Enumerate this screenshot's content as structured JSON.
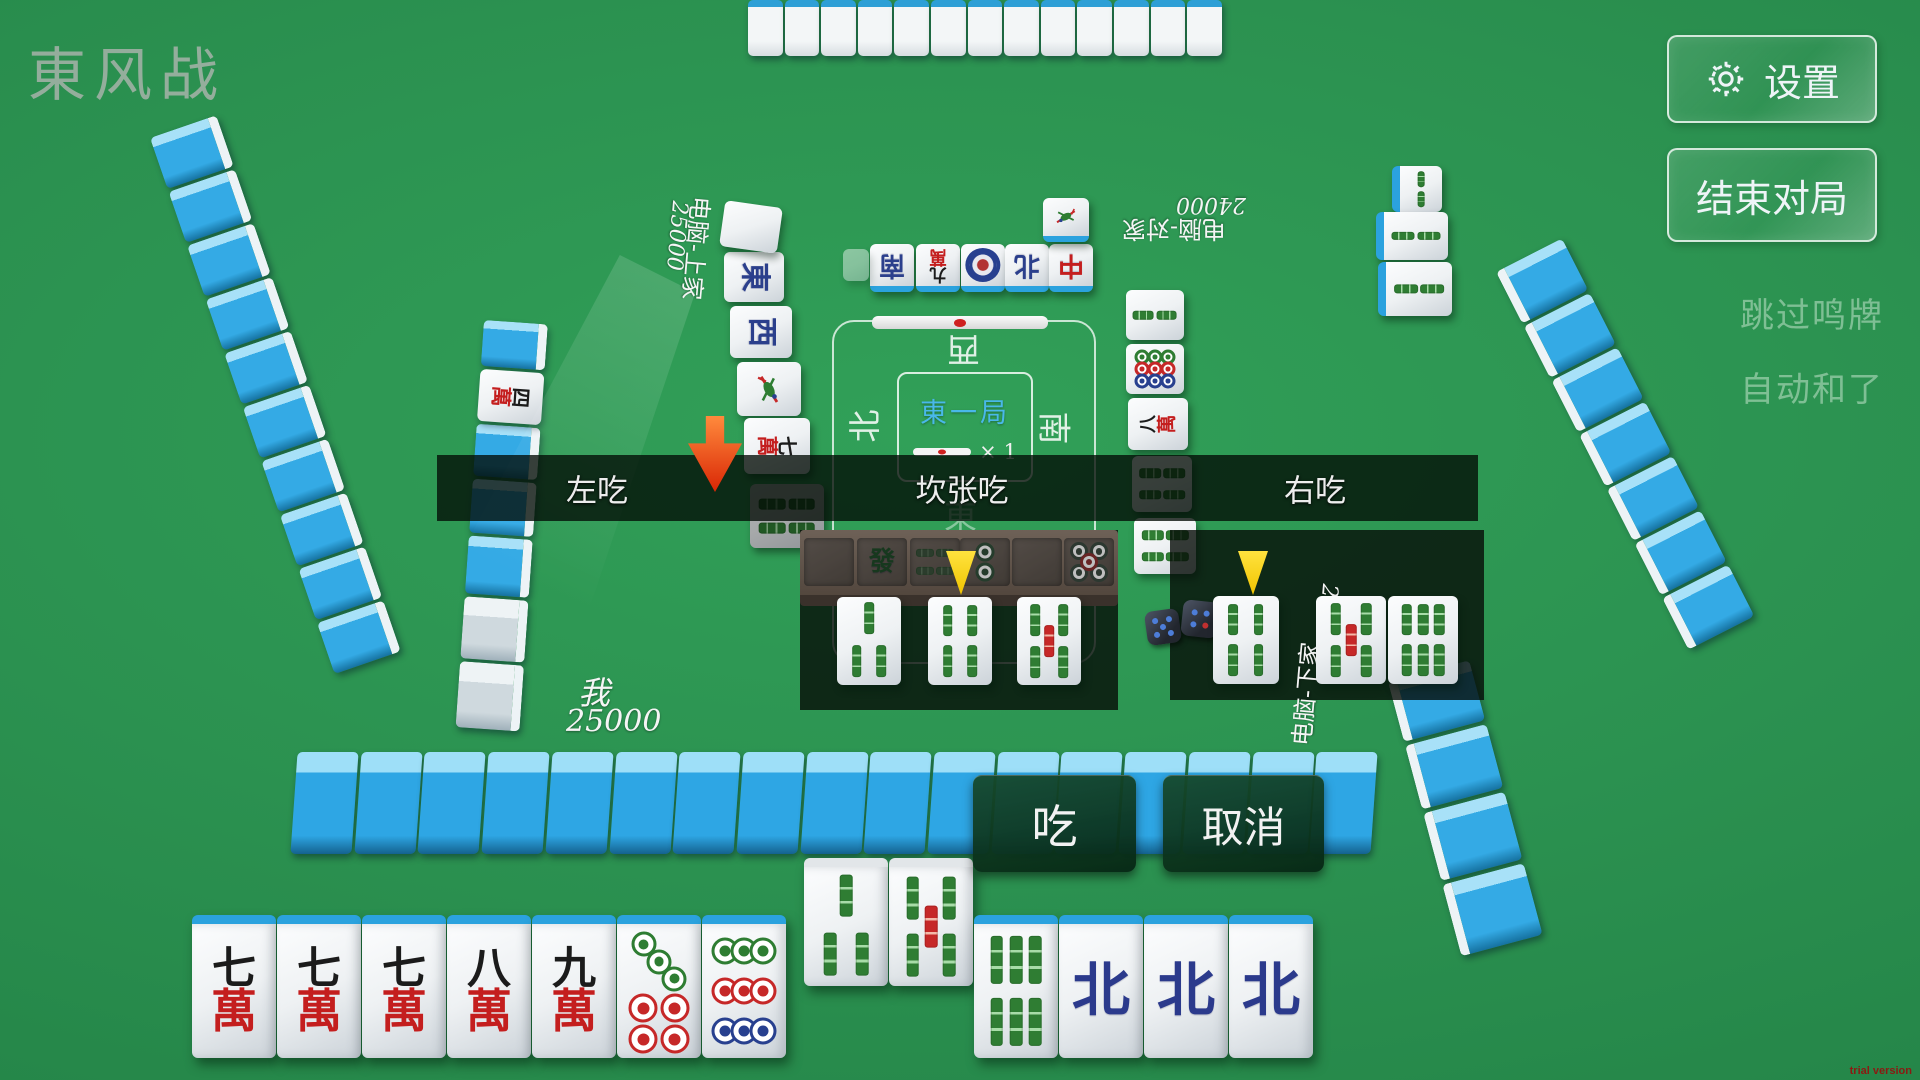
{
  "title": "東风战",
  "top_right": {
    "settings": "设置",
    "end_game": "结束对局"
  },
  "right_options": {
    "skip_call": "跳过鸣牌",
    "auto_win": "自动和了"
  },
  "call_bar": {
    "left": "左吃",
    "middle": "坎张吃",
    "right": "右吃"
  },
  "action_buttons": {
    "chi": "吃",
    "cancel": "取消"
  },
  "center": {
    "round": "東一局",
    "multiplier": "× 1",
    "wind_top": "西",
    "wind_left": "北",
    "wind_right": "南",
    "wind_bottom": "東"
  },
  "players": {
    "left": {
      "name": "电脑-上家",
      "score": "25000"
    },
    "top": {
      "name": "电脑-对家",
      "score": "24000"
    },
    "right": {
      "name": "电脑-下家",
      "score": "25000"
    },
    "self": {
      "name": "我",
      "score": "25000"
    }
  },
  "man_char": "萬",
  "dora_indicator": {
    "suit": "man",
    "num": "四"
  },
  "hand": {
    "tiles": [
      {
        "suit": "man",
        "num": "七"
      },
      {
        "suit": "man",
        "num": "七"
      },
      {
        "suit": "man",
        "num": "七"
      },
      {
        "suit": "man",
        "num": "八"
      },
      {
        "suit": "man",
        "num": "九"
      },
      {
        "suit": "pin",
        "value": 7
      },
      {
        "suit": "pin",
        "value": 9
      },
      {
        "suit": "sou",
        "value": 3,
        "raised": true
      },
      {
        "suit": "sou",
        "value": 5,
        "raised": true
      },
      {
        "suit": "sou",
        "value": 6
      },
      {
        "suit": "honor",
        "label": "北"
      },
      {
        "suit": "honor",
        "label": "北"
      },
      {
        "suit": "honor",
        "label": "北"
      }
    ]
  },
  "chi_preview": {
    "middle": [
      {
        "suit": "sou",
        "value": 3
      },
      {
        "suit": "sou",
        "value": 4
      },
      {
        "suit": "sou",
        "value": 5
      }
    ],
    "right_called": {
      "suit": "sou",
      "value": 4
    },
    "right_pair": [
      {
        "suit": "sou",
        "value": 5
      },
      {
        "suit": "sou",
        "value": 6
      }
    ]
  },
  "discards": {
    "left": [
      {
        "type": "text",
        "label": "東",
        "color": "#2b3f8c"
      },
      {
        "type": "text",
        "label": "西",
        "color": "#2b3f8c"
      },
      {
        "type": "bird"
      },
      {
        "type": "man",
        "num": "七"
      },
      {
        "type": "souflat",
        "chains": 4
      }
    ],
    "top": [
      {
        "type": "text",
        "label": "南",
        "color": "#2b3f8c"
      },
      {
        "type": "man",
        "num": "九"
      },
      {
        "type": "pin1"
      },
      {
        "type": "text",
        "label": "北",
        "color": "#2b3f8c"
      },
      {
        "type": "text",
        "label": "中",
        "color": "#c41e1e"
      },
      {
        "type": "bird"
      }
    ],
    "right": [
      {
        "type": "souflat",
        "chains": 2
      },
      {
        "type": "pin9s"
      },
      {
        "type": "man",
        "num": "八"
      },
      {
        "type": "souflat",
        "chains": 4
      },
      {
        "type": "souflat",
        "chains": 4
      }
    ],
    "right_meld": [
      {
        "type": "souvert2"
      },
      {
        "type": "souflat",
        "chains": 2
      },
      {
        "type": "souflat",
        "chains": 2
      }
    ]
  },
  "board_tiles": [
    {
      "type": "empty"
    },
    {
      "type": "text",
      "label": "發",
      "color": "#1f4b28"
    },
    {
      "type": "souflat",
      "chains": 4
    },
    {
      "type": "pin2"
    },
    {
      "type": "empty"
    },
    {
      "type": "pin5"
    }
  ],
  "trial": "trial version",
  "colors": {
    "accent_cyan": "#49b8e9",
    "tile_back_blue": "#2da4e2",
    "button_green": "#0d3d20",
    "arrow_red": "#e63912",
    "arrow_yellow": "#ffd820"
  }
}
